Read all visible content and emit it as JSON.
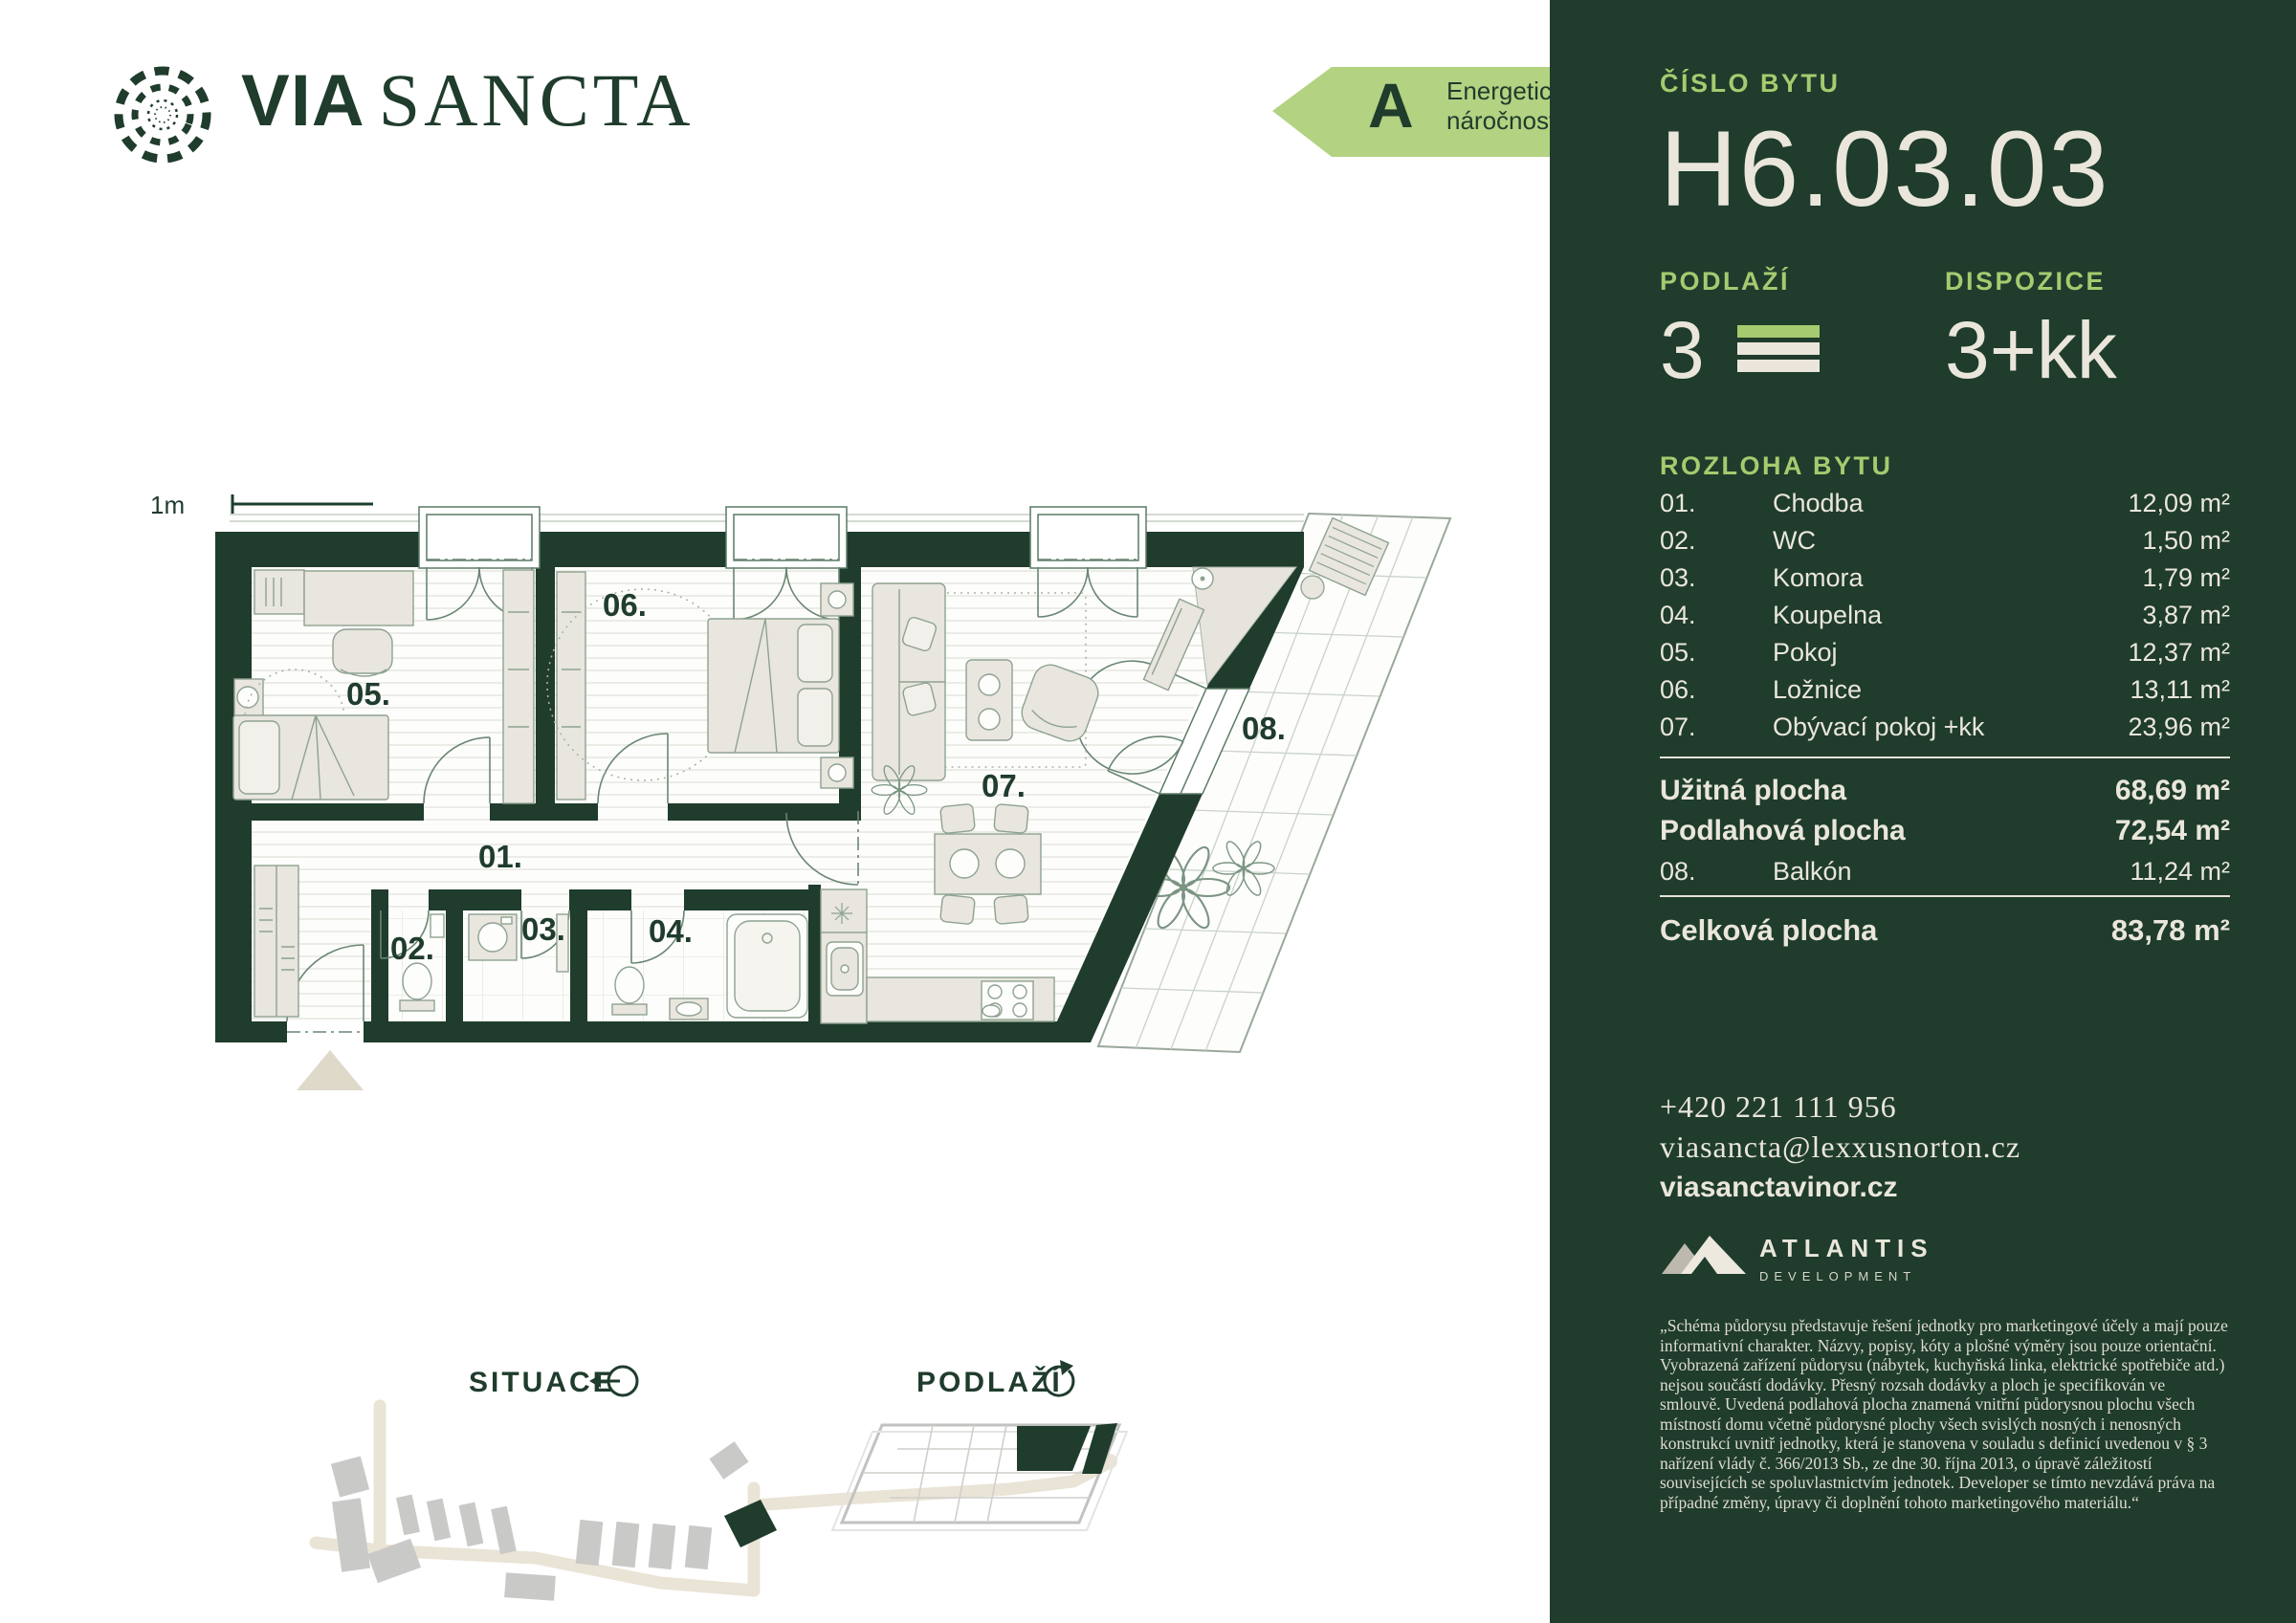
{
  "brand": {
    "word1": "VIA",
    "word2": "SANCTA"
  },
  "energy_badge": {
    "grade": "A",
    "label_line1": "Energetická",
    "label_line2": "náročnost"
  },
  "panel": {
    "unit_label": "ČÍSLO BYTU",
    "unit_number": "H6.03.03",
    "floor": {
      "label": "PODLAŽÍ",
      "value": "3"
    },
    "disposition": {
      "label": "DISPOZICE",
      "value": "3+kk"
    },
    "rooms_heading": "ROZLOHA BYTU",
    "rooms": [
      {
        "num": "01.",
        "name": "Chodba",
        "area": "12,09 m²"
      },
      {
        "num": "02.",
        "name": "WC",
        "area": "1,50 m²"
      },
      {
        "num": "03.",
        "name": "Komora",
        "area": "1,79 m²"
      },
      {
        "num": "04.",
        "name": "Koupelna",
        "area": "3,87 m²"
      },
      {
        "num": "05.",
        "name": "Pokoj",
        "area": "12,37 m²"
      },
      {
        "num": "06.",
        "name": "Ložnice",
        "area": "13,11 m²"
      },
      {
        "num": "07.",
        "name": "Obývací pokoj +kk",
        "area": "23,96 m²"
      }
    ],
    "usable_area": {
      "label": "Užitná plocha",
      "value": "68,69 m²"
    },
    "floor_area": {
      "label": "Podlahová plocha",
      "value": "72,54 m²"
    },
    "balcony": {
      "num": "08.",
      "name": "Balkón",
      "area": "11,24 m²"
    },
    "total_area": {
      "label": "Celková plocha",
      "value": "83,78 m²"
    },
    "contact": {
      "phone": "+420 221 111 956",
      "email": "viasancta@lexxusnorton.cz",
      "web": "viasanctavinor.cz"
    },
    "developer": {
      "name": "ATLANTIS",
      "subtitle": "DEVELOPMENT"
    },
    "disclaimer": "„Schéma půdorysu představuje řešení jednotky pro marketingové účely a mají pouze informativní charakter. Názvy, popisy, kóty a plošné výměry jsou pouze orientační. Vyobrazená zařízení půdorysu (nábytek, kuchyňská linka, elektrické spotřebiče atd.) nejsou součástí dodávky. Přesný rozsah dodávky a ploch je specifikován ve smlouvě. Uvedená podlahová plocha znamená vnitřní půdorysnou plochu všech místností domu včetně půdorysné plochy všech svislých nosných i nenosných konstrukcí uvnitř jednotky, která je stanovena v souladu s definicí uvedenou v § 3 nařízení vlády č. 366/2013 Sb., ze dne 30. října 2013, o úpravě záležitostí souvisejících se spoluvlastnictvím jednotek. Developer se tímto nevzdává práva na případné změny, úpravy či doplnění tohoto marketingového materiálu.“"
  },
  "floorplan": {
    "scale_label": "1m",
    "labels": {
      "r01": "01.",
      "r02": "02.",
      "r03": "03.",
      "r04": "04.",
      "r05": "05.",
      "r06": "06.",
      "r07": "07.",
      "r08": "08."
    }
  },
  "minimaps": {
    "site_label": "SITUACE",
    "floor_label": "PODLAŽÍ"
  },
  "colors": {
    "dark_green": "#1F3C2C",
    "lime": "#A6CA6F",
    "cream": "#EAE6DB",
    "badge_green": "#B3D282"
  }
}
